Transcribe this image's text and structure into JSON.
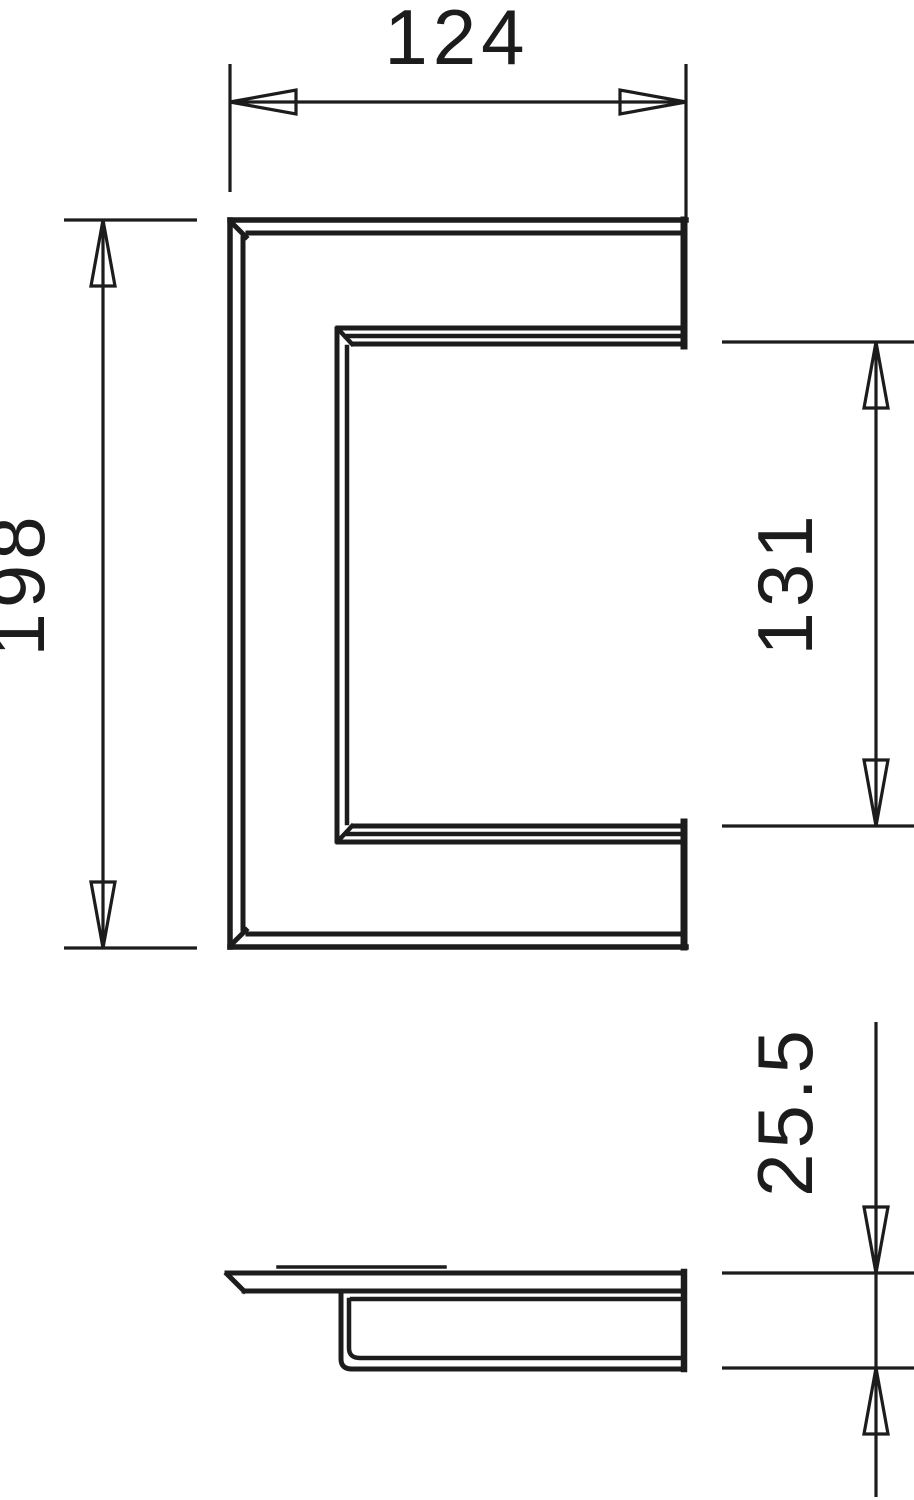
{
  "drawing": {
    "background": "#ffffff",
    "line_color": "#1c1c1c",
    "labels": {
      "width": "124",
      "height": "198",
      "opening_height": "131",
      "depth": "25.5"
    }
  }
}
